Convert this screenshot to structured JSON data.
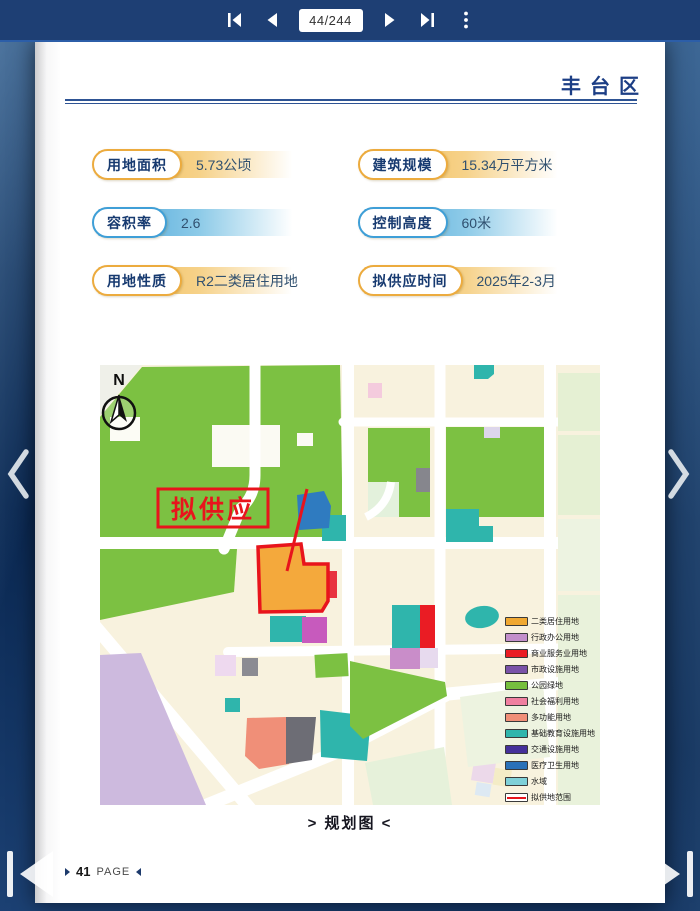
{
  "toolbar": {
    "page_indicator": "44/244",
    "icons": [
      "first-page",
      "previous-page",
      "next-page",
      "last-page",
      "more-options"
    ]
  },
  "colors": {
    "accent_navy": "#1c3e85",
    "accent_gold": "#ecab3e",
    "accent_blue": "#3f9fd7",
    "highlight_red": "#e8141c",
    "highlight_fill": "#f4a93c"
  },
  "page": {
    "header": {
      "district": "丰台区"
    },
    "info_cards": [
      {
        "label": "用地面积",
        "value": "5.73公顷",
        "theme": "gold"
      },
      {
        "label": "建筑规模",
        "value": "15.34万平方米",
        "theme": "gold"
      },
      {
        "label": "容积率",
        "value": "2.6",
        "theme": "blue"
      },
      {
        "label": "控制高度",
        "value": "60米",
        "theme": "blue"
      },
      {
        "label": "用地性质",
        "value": "R2二类居住用地",
        "theme": "gold"
      },
      {
        "label": "拟供应时间",
        "value": "2025年2-3月",
        "theme": "gold"
      }
    ],
    "map": {
      "north_label": "N",
      "callout": "拟供应",
      "legend": [
        {
          "label": "二类居住用地",
          "color": "#F0A832"
        },
        {
          "label": "行政办公用地",
          "color": "#C38FCB"
        },
        {
          "label": "商业服务业用地",
          "color": "#EA1C24"
        },
        {
          "label": "市政设施用地",
          "color": "#7A52A8"
        },
        {
          "label": "公园绿地",
          "color": "#76BF3E"
        },
        {
          "label": "社会福利用地",
          "color": "#F07FA0"
        },
        {
          "label": "多功能用地",
          "color": "#F08F78"
        },
        {
          "label": "基础教育设施用地",
          "color": "#2FB5AC"
        },
        {
          "label": "交通设施用地",
          "color": "#44309A"
        },
        {
          "label": "医疗卫生用地",
          "color": "#2A71B8"
        },
        {
          "label": "水域",
          "color": "#7FD0D8"
        },
        {
          "label": "拟供地范围",
          "color": "#E8141C",
          "type": "outline"
        }
      ]
    },
    "caption": "> 规划图 <",
    "footer": {
      "page_number": "41",
      "page_label": "PAGE"
    }
  }
}
